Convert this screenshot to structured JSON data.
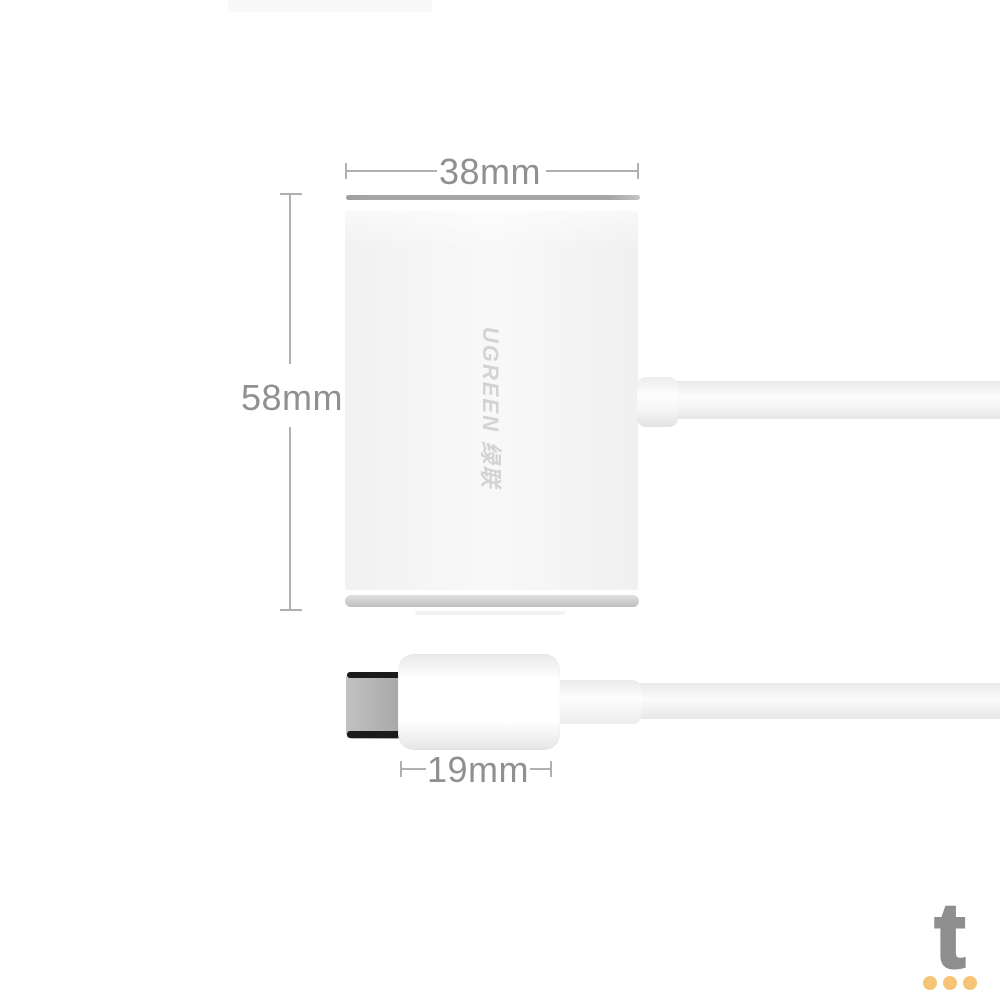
{
  "background_color": "#ffffff",
  "annotations": {
    "line_color": "#b0b0b0",
    "label_color": "#909090",
    "width_label": "38mm",
    "height_label": "58mm",
    "plug_width_label": "19mm"
  },
  "product": {
    "brand_text": "UGREEN 绿联",
    "brand_text_color": "#d3d3d3",
    "body_color": "#f6f6f6",
    "top_edge_color": "#a6a6a6",
    "bottom_edge_color": "#cccccc",
    "cable_color": "#f7f7f7",
    "plug_color": "#ffffff",
    "metal_tip_color": "#ababab",
    "metal_tip_edge_color": "#1b1b1b"
  },
  "watermark": {
    "letter": "t",
    "letter_color": "#8e8e8e",
    "dot_color": "#f5c476"
  }
}
